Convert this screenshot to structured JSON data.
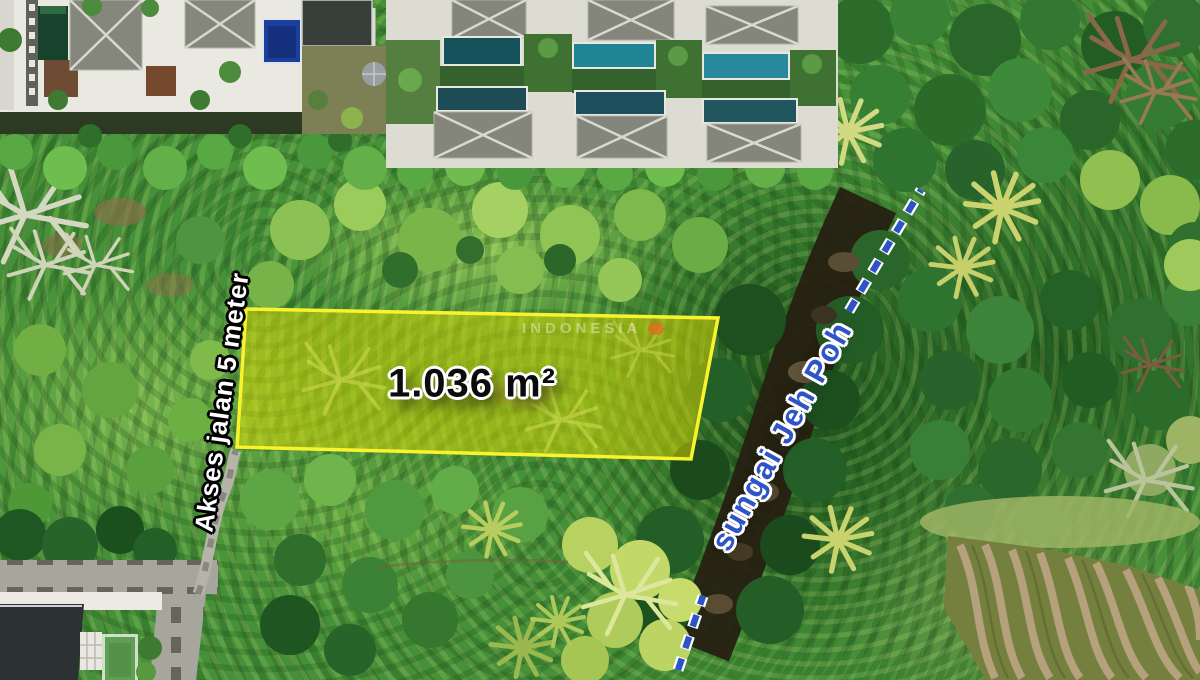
{
  "annotations": {
    "plot_area_label": "1.036 m²",
    "access_road_label": "Akses jalan 5 meter",
    "river_label": "sungai Jeh Poh",
    "watermark": "INDONESIA"
  },
  "colors": {
    "plot_fill": "#e8e000",
    "plot_outline": "#f8f32c",
    "river_label_blue": "#2e54c8",
    "river_dash_blue": "#2d53c4",
    "area_label_text": "#0b0b0b",
    "access_label_text": "#ffffff"
  }
}
